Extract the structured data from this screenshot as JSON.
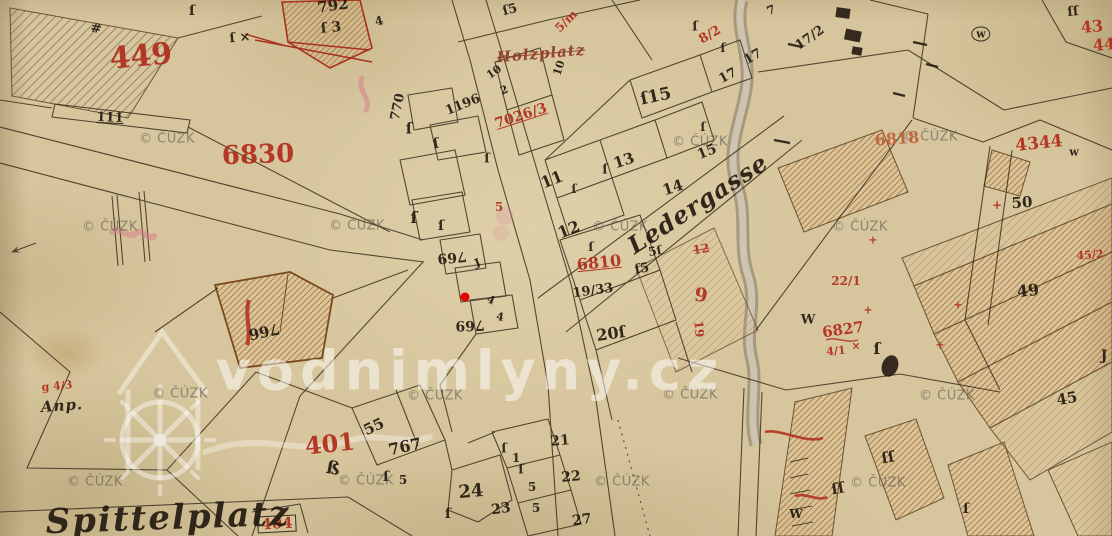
{
  "palette": {
    "ink": "#241a10",
    "red": "#b02c1c",
    "fred": "#c2603a",
    "dred": "#8f3b28"
  },
  "watermark": {
    "text": "© ČÚZK",
    "positions": [
      {
        "x": 167,
        "y": 139
      },
      {
        "x": 700,
        "y": 142
      },
      {
        "x": 930,
        "y": 137
      },
      {
        "x": 110,
        "y": 227
      },
      {
        "x": 357,
        "y": 226
      },
      {
        "x": 620,
        "y": 227
      },
      {
        "x": 860,
        "y": 227
      },
      {
        "x": 180,
        "y": 394
      },
      {
        "x": 435,
        "y": 396
      },
      {
        "x": 690,
        "y": 395
      },
      {
        "x": 947,
        "y": 396
      },
      {
        "x": 95,
        "y": 482
      },
      {
        "x": 366,
        "y": 481
      },
      {
        "x": 622,
        "y": 482
      },
      {
        "x": 878,
        "y": 483
      }
    ]
  },
  "site_watermark": {
    "text": "vodnimlyny.cz"
  },
  "marker": {
    "x": 465,
    "y": 297
  },
  "labels": [
    {
      "t": "449",
      "x": 141,
      "y": 57,
      "s": 30,
      "r": -5,
      "c": "red",
      "name": "parcel-number-449"
    },
    {
      "t": "#",
      "x": 96,
      "y": 29,
      "s": 13,
      "r": 10,
      "c": "ink"
    },
    {
      "t": "ſ",
      "x": 192,
      "y": 11,
      "s": 14,
      "r": 0,
      "c": "ink"
    },
    {
      "t": "ſ ×",
      "x": 240,
      "y": 38,
      "s": 13,
      "r": -5,
      "c": "ink"
    },
    {
      "t": "792",
      "x": 333,
      "y": 6,
      "s": 15,
      "r": -8,
      "c": "ink"
    },
    {
      "t": "ſ 3",
      "x": 331,
      "y": 28,
      "s": 14,
      "r": -5,
      "c": "ink"
    },
    {
      "t": "4",
      "x": 379,
      "y": 21,
      "s": 12,
      "r": -15,
      "c": "ink"
    },
    {
      "t": "111",
      "x": 110,
      "y": 118,
      "s": 13,
      "r": 2,
      "c": "ink",
      "u": true
    },
    {
      "t": "6830",
      "x": 258,
      "y": 155,
      "s": 26,
      "r": -2,
      "c": "red",
      "name": "parcel-number-6830"
    },
    {
      "t": "770",
      "x": 398,
      "y": 107,
      "s": 13,
      "r": -78,
      "c": "ink"
    },
    {
      "t": "1196",
      "x": 463,
      "y": 105,
      "s": 13,
      "r": -22,
      "c": "ink"
    },
    {
      "t": "10",
      "x": 494,
      "y": 72,
      "s": 11,
      "r": -35,
      "c": "ink"
    },
    {
      "t": "2",
      "x": 504,
      "y": 90,
      "s": 11,
      "r": -20,
      "c": "ink"
    },
    {
      "t": "ſ5",
      "x": 510,
      "y": 10,
      "s": 13,
      "r": -15,
      "c": "ink"
    },
    {
      "t": "5/m",
      "x": 566,
      "y": 21,
      "s": 12,
      "r": -45,
      "c": "red"
    },
    {
      "t": "Holzplatz",
      "x": 541,
      "y": 54,
      "s": 15,
      "r": -5,
      "c": "dred",
      "f": "script",
      "k": true,
      "name": "street-label-holzplatz-struck"
    },
    {
      "t": "7026/3",
      "x": 521,
      "y": 116,
      "s": 14,
      "r": -18,
      "c": "red",
      "u": true
    },
    {
      "t": "10",
      "x": 559,
      "y": 68,
      "s": 11,
      "r": -72,
      "c": "ink"
    },
    {
      "t": "ſ",
      "x": 409,
      "y": 129,
      "s": 15,
      "r": 0,
      "c": "ink"
    },
    {
      "t": "ſ",
      "x": 436,
      "y": 144,
      "s": 14,
      "r": -10,
      "c": "ink"
    },
    {
      "t": "ſ",
      "x": 414,
      "y": 218,
      "s": 16,
      "r": 0,
      "c": "ink"
    },
    {
      "t": "ſ",
      "x": 441,
      "y": 226,
      "s": 14,
      "r": 0,
      "c": "ink"
    },
    {
      "t": "ſ",
      "x": 487,
      "y": 159,
      "s": 13,
      "r": 0,
      "c": "ink"
    },
    {
      "t": "5",
      "x": 499,
      "y": 207,
      "s": 12,
      "r": 0,
      "c": "red"
    },
    {
      "t": "769",
      "x": 452,
      "y": 257,
      "s": 14,
      "r": 175,
      "c": "ink"
    },
    {
      "t": "ſ",
      "x": 477,
      "y": 262,
      "s": 13,
      "r": 160,
      "c": "ink"
    },
    {
      "t": "4",
      "x": 491,
      "y": 300,
      "s": 11,
      "r": 25,
      "c": "ink"
    },
    {
      "t": "4",
      "x": 500,
      "y": 317,
      "s": 11,
      "r": 10,
      "c": "ink"
    },
    {
      "t": "769",
      "x": 470,
      "y": 325,
      "s": 14,
      "r": 178,
      "c": "ink"
    },
    {
      "t": "7",
      "x": 771,
      "y": 10,
      "s": 12,
      "r": -20,
      "c": "ink"
    },
    {
      "t": "17",
      "x": 728,
      "y": 76,
      "s": 13,
      "r": -28,
      "c": "ink"
    },
    {
      "t": "17",
      "x": 753,
      "y": 57,
      "s": 13,
      "r": -30,
      "c": "ink"
    },
    {
      "t": "ſ15",
      "x": 656,
      "y": 97,
      "s": 17,
      "r": -12,
      "c": "ink",
      "name": "house-number-15"
    },
    {
      "t": "13",
      "x": 624,
      "y": 161,
      "s": 15,
      "r": -18,
      "c": "ink"
    },
    {
      "t": "ſ",
      "x": 605,
      "y": 170,
      "s": 13,
      "r": 0,
      "c": "ink"
    },
    {
      "t": "11",
      "x": 552,
      "y": 180,
      "s": 16,
      "r": -22,
      "c": "ink"
    },
    {
      "t": "ſ",
      "x": 574,
      "y": 189,
      "s": 12,
      "r": 0,
      "c": "ink"
    },
    {
      "t": "12",
      "x": 569,
      "y": 230,
      "s": 16,
      "r": -22,
      "c": "ink",
      "name": "house-number-12"
    },
    {
      "t": "ſ",
      "x": 591,
      "y": 247,
      "s": 12,
      "r": 0,
      "c": "ink"
    },
    {
      "t": "14",
      "x": 673,
      "y": 188,
      "s": 15,
      "r": -18,
      "c": "ink"
    },
    {
      "t": "15",
      "x": 707,
      "y": 152,
      "s": 14,
      "r": -22,
      "c": "ink"
    },
    {
      "t": "ſ",
      "x": 703,
      "y": 127,
      "s": 12,
      "r": 0,
      "c": "ink"
    },
    {
      "t": "Ledergasse",
      "x": 698,
      "y": 204,
      "s": 24,
      "r": -33,
      "c": "ink",
      "f": "script",
      "name": "street-label-ledergasse"
    },
    {
      "t": "6810",
      "x": 599,
      "y": 263,
      "s": 16,
      "r": -6,
      "c": "red",
      "u": true,
      "name": "parcel-number-6810"
    },
    {
      "t": "19/33",
      "x": 593,
      "y": 291,
      "s": 13,
      "r": -8,
      "c": "ink"
    },
    {
      "t": "ſ5",
      "x": 642,
      "y": 269,
      "s": 13,
      "r": -10,
      "c": "ink"
    },
    {
      "t": "5ſ",
      "x": 655,
      "y": 251,
      "s": 12,
      "r": -10,
      "c": "ink"
    },
    {
      "t": "12",
      "x": 701,
      "y": 249,
      "s": 12,
      "r": -10,
      "c": "red",
      "k": true
    },
    {
      "t": "9",
      "x": 701,
      "y": 296,
      "s": 19,
      "r": 8,
      "c": "red"
    },
    {
      "t": "19",
      "x": 699,
      "y": 329,
      "s": 12,
      "r": 85,
      "c": "red"
    },
    {
      "t": "20ſ",
      "x": 611,
      "y": 334,
      "s": 16,
      "r": -8,
      "c": "ink"
    },
    {
      "t": "W",
      "x": 808,
      "y": 320,
      "s": 13,
      "r": 0,
      "c": "ink"
    },
    {
      "t": "6827",
      "x": 843,
      "y": 330,
      "s": 15,
      "r": -8,
      "c": "red",
      "name": "parcel-number-6827"
    },
    {
      "t": "4/1",
      "x": 836,
      "y": 351,
      "s": 11,
      "r": -5,
      "c": "red"
    },
    {
      "t": "×",
      "x": 856,
      "y": 346,
      "s": 11,
      "r": 0,
      "c": "red"
    },
    {
      "t": "ſ",
      "x": 877,
      "y": 349,
      "s": 16,
      "r": 0,
      "c": "ink"
    },
    {
      "t": "50",
      "x": 1022,
      "y": 203,
      "s": 15,
      "r": -4,
      "c": "ink",
      "name": "house-number-50"
    },
    {
      "t": "+",
      "x": 997,
      "y": 205,
      "s": 12,
      "r": 0,
      "c": "red"
    },
    {
      "t": "49",
      "x": 1028,
      "y": 291,
      "s": 16,
      "r": -6,
      "c": "ink",
      "name": "house-number-49"
    },
    {
      "t": "45",
      "x": 1067,
      "y": 399,
      "s": 15,
      "r": -10,
      "c": "ink"
    },
    {
      "t": "22/1",
      "x": 846,
      "y": 281,
      "s": 12,
      "r": 0,
      "c": "red"
    },
    {
      "t": "45/2",
      "x": 1090,
      "y": 255,
      "s": 11,
      "r": -5,
      "c": "red"
    },
    {
      "t": "+",
      "x": 868,
      "y": 310,
      "s": 11,
      "r": 0,
      "c": "red"
    },
    {
      "t": "+",
      "x": 873,
      "y": 240,
      "s": 11,
      "r": 0,
      "c": "red"
    },
    {
      "t": "+",
      "x": 958,
      "y": 305,
      "s": 11,
      "r": 0,
      "c": "red"
    },
    {
      "t": "+",
      "x": 940,
      "y": 345,
      "s": 11,
      "r": 0,
      "c": "red"
    },
    {
      "t": "4344",
      "x": 1039,
      "y": 144,
      "s": 17,
      "r": -6,
      "c": "red",
      "name": "parcel-number-4344"
    },
    {
      "t": "w",
      "x": 1074,
      "y": 152,
      "s": 11,
      "r": 0,
      "c": "ink"
    },
    {
      "t": "6818",
      "x": 897,
      "y": 139,
      "s": 16,
      "r": -4,
      "c": "fred",
      "name": "parcel-number-6818"
    },
    {
      "t": "43",
      "x": 1092,
      "y": 27,
      "s": 16,
      "r": -5,
      "c": "red"
    },
    {
      "t": "44",
      "x": 1104,
      "y": 45,
      "s": 16,
      "r": -5,
      "c": "red"
    },
    {
      "t": "17/2",
      "x": 810,
      "y": 38,
      "s": 13,
      "r": -35,
      "c": "ink"
    },
    {
      "t": "8/2",
      "x": 710,
      "y": 35,
      "s": 13,
      "r": -30,
      "c": "red"
    },
    {
      "t": "ſ",
      "x": 695,
      "y": 27,
      "s": 13,
      "r": 0,
      "c": "ink"
    },
    {
      "t": "ſ",
      "x": 723,
      "y": 48,
      "s": 12,
      "r": 0,
      "c": "ink"
    },
    {
      "t": "w",
      "x": 981,
      "y": 34,
      "s": 11,
      "r": 0,
      "c": "ink",
      "circ": true
    },
    {
      "t": "ſſ",
      "x": 1073,
      "y": 12,
      "s": 13,
      "r": -5,
      "c": "ink"
    },
    {
      "t": "Anp.",
      "x": 62,
      "y": 406,
      "s": 15,
      "r": -4,
      "c": "ink",
      "f": "script"
    },
    {
      "t": "g 4/3",
      "x": 57,
      "y": 386,
      "s": 11,
      "r": -5,
      "c": "red"
    },
    {
      "t": "401",
      "x": 330,
      "y": 444,
      "s": 24,
      "r": -6,
      "c": "red",
      "name": "parcel-number-401"
    },
    {
      "t": "ß",
      "x": 333,
      "y": 469,
      "s": 18,
      "r": 10,
      "c": "ink"
    },
    {
      "t": "55",
      "x": 374,
      "y": 427,
      "s": 15,
      "r": -25,
      "c": "ink"
    },
    {
      "t": "767",
      "x": 405,
      "y": 447,
      "s": 16,
      "r": -12,
      "c": "ink",
      "name": "house-number-767"
    },
    {
      "t": "ſ",
      "x": 386,
      "y": 477,
      "s": 14,
      "r": 0,
      "c": "ink"
    },
    {
      "t": "5",
      "x": 403,
      "y": 480,
      "s": 12,
      "r": 0,
      "c": "ink"
    },
    {
      "t": "24",
      "x": 471,
      "y": 492,
      "s": 18,
      "r": -5,
      "c": "ink"
    },
    {
      "t": "23",
      "x": 501,
      "y": 509,
      "s": 14,
      "r": -8,
      "c": "ink"
    },
    {
      "t": "ſ",
      "x": 448,
      "y": 514,
      "s": 14,
      "r": 0,
      "c": "ink"
    },
    {
      "t": "21",
      "x": 560,
      "y": 441,
      "s": 14,
      "r": -5,
      "c": "ink"
    },
    {
      "t": "22",
      "x": 571,
      "y": 477,
      "s": 14,
      "r": -5,
      "c": "ink"
    },
    {
      "t": "27",
      "x": 582,
      "y": 520,
      "s": 14,
      "r": -8,
      "c": "ink"
    },
    {
      "t": "1",
      "x": 516,
      "y": 458,
      "s": 12,
      "r": 0,
      "c": "ink"
    },
    {
      "t": "ſ",
      "x": 521,
      "y": 470,
      "s": 13,
      "r": 0,
      "c": "ink"
    },
    {
      "t": "5",
      "x": 532,
      "y": 487,
      "s": 12,
      "r": 0,
      "c": "ink"
    },
    {
      "t": "5",
      "x": 536,
      "y": 508,
      "s": 12,
      "r": 0,
      "c": "ink"
    },
    {
      "t": "ſ",
      "x": 504,
      "y": 449,
      "s": 13,
      "r": 0,
      "c": "ink"
    },
    {
      "t": "404",
      "x": 277,
      "y": 524,
      "s": 15,
      "r": -3,
      "c": "red",
      "box": true,
      "name": "parcel-number-404"
    },
    {
      "t": "Spittelplatz",
      "x": 168,
      "y": 518,
      "s": 34,
      "r": -2,
      "c": "ink",
      "f": "big-script",
      "name": "street-label-spittelplatz"
    },
    {
      "t": "766",
      "x": 264,
      "y": 331,
      "s": 15,
      "r": 168,
      "c": "ink",
      "name": "house-number-766"
    },
    {
      "t": "ſſ",
      "x": 888,
      "y": 458,
      "s": 15,
      "r": -10,
      "c": "ink"
    },
    {
      "t": "ſſ",
      "x": 838,
      "y": 489,
      "s": 15,
      "r": -10,
      "c": "ink"
    },
    {
      "t": "ſ",
      "x": 966,
      "y": 509,
      "s": 14,
      "r": 0,
      "c": "ink"
    },
    {
      "t": "W",
      "x": 796,
      "y": 514,
      "s": 12,
      "r": 0,
      "c": "ink"
    },
    {
      "t": "J",
      "x": 1104,
      "y": 356,
      "s": 14,
      "r": 0,
      "c": "ink"
    }
  ]
}
